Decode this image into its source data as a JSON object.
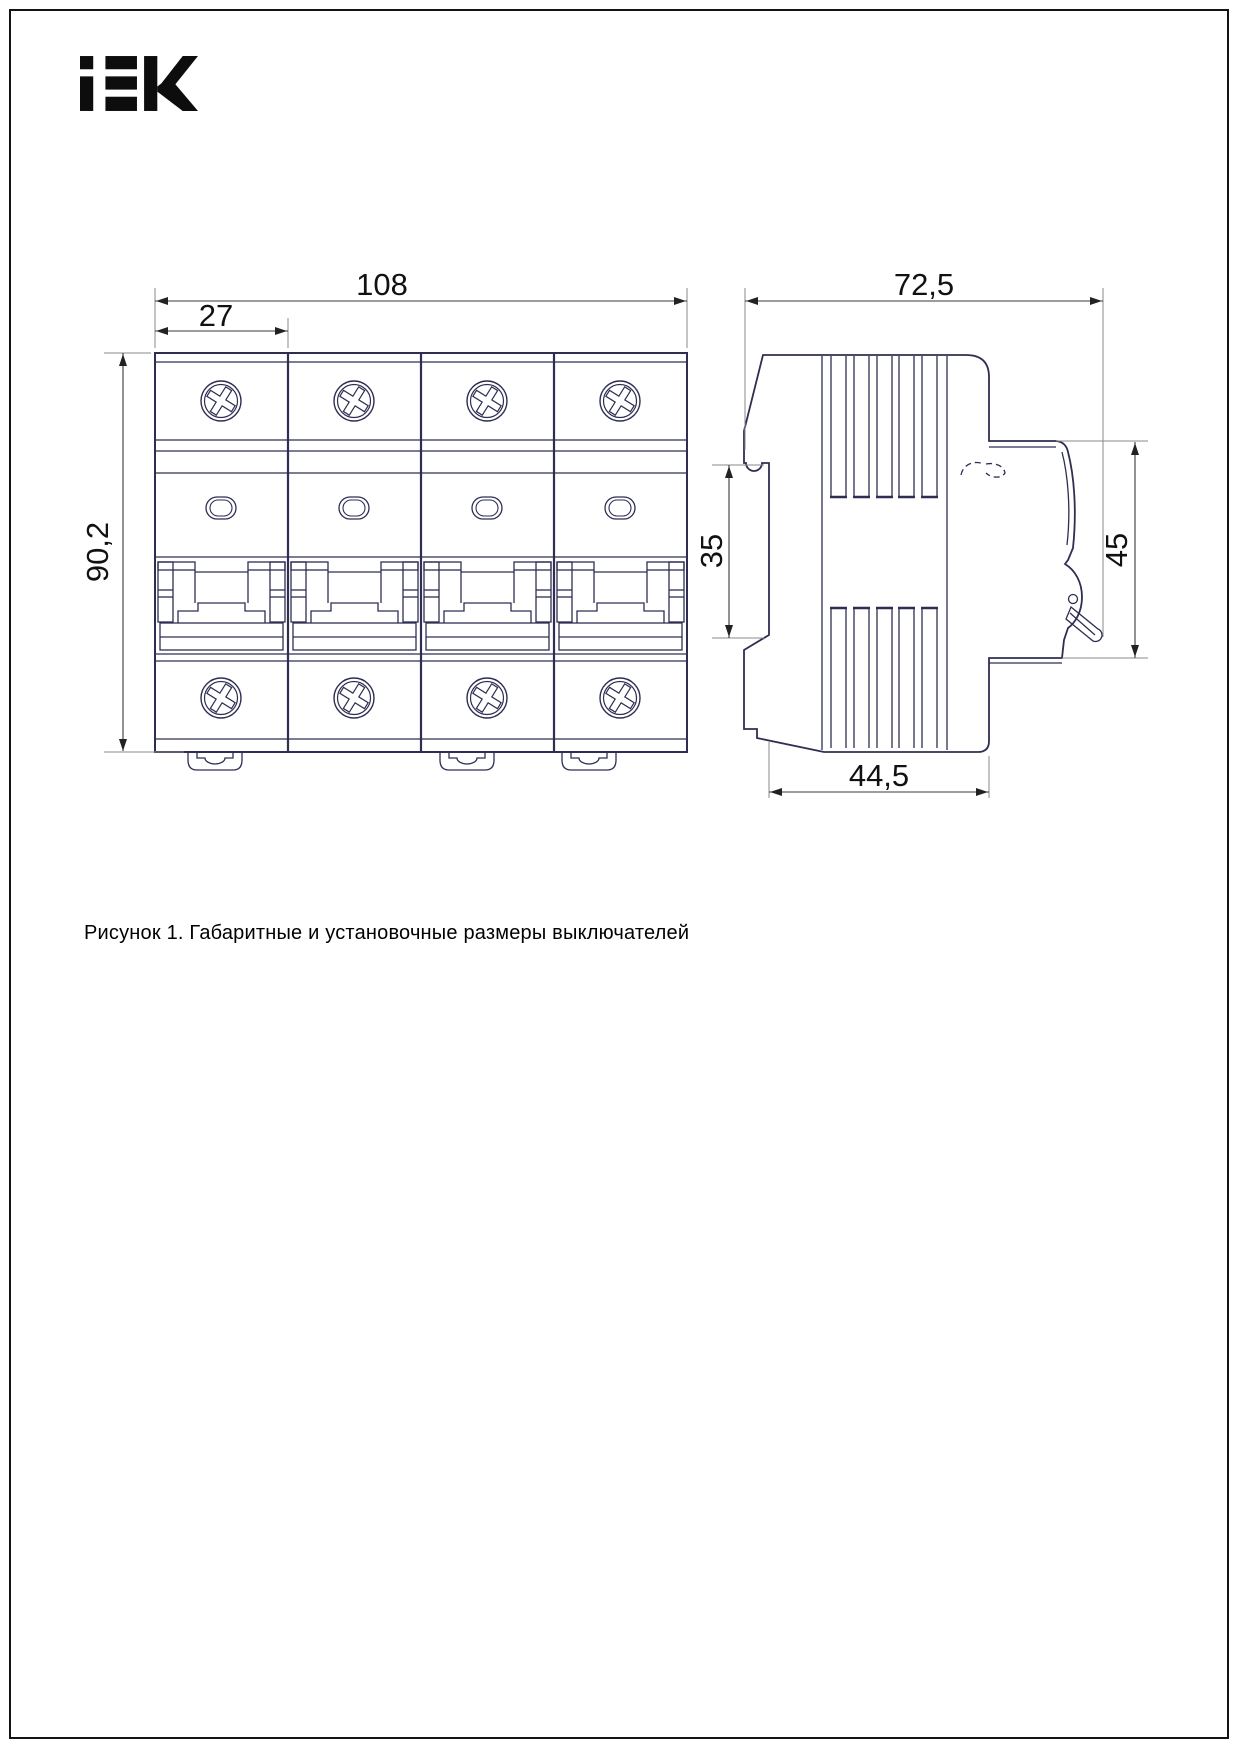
{
  "logo": {
    "text": "IEK"
  },
  "caption": "Рисунок 1. Габаритные и установочные размеры выключателей",
  "dimensions": {
    "front_total_width": "108",
    "module_width": "27",
    "front_height": "90,2",
    "side_total_width": "72,5",
    "din_slot_height": "35",
    "front_protrusion_height": "45",
    "mount_depth": "44,5"
  },
  "colors": {
    "drawing_line": "#2e2e52",
    "dimension_line": "#3a3a3a",
    "extension_line": "#8a8a8a",
    "text": "#111111",
    "page_border": "#141414"
  }
}
